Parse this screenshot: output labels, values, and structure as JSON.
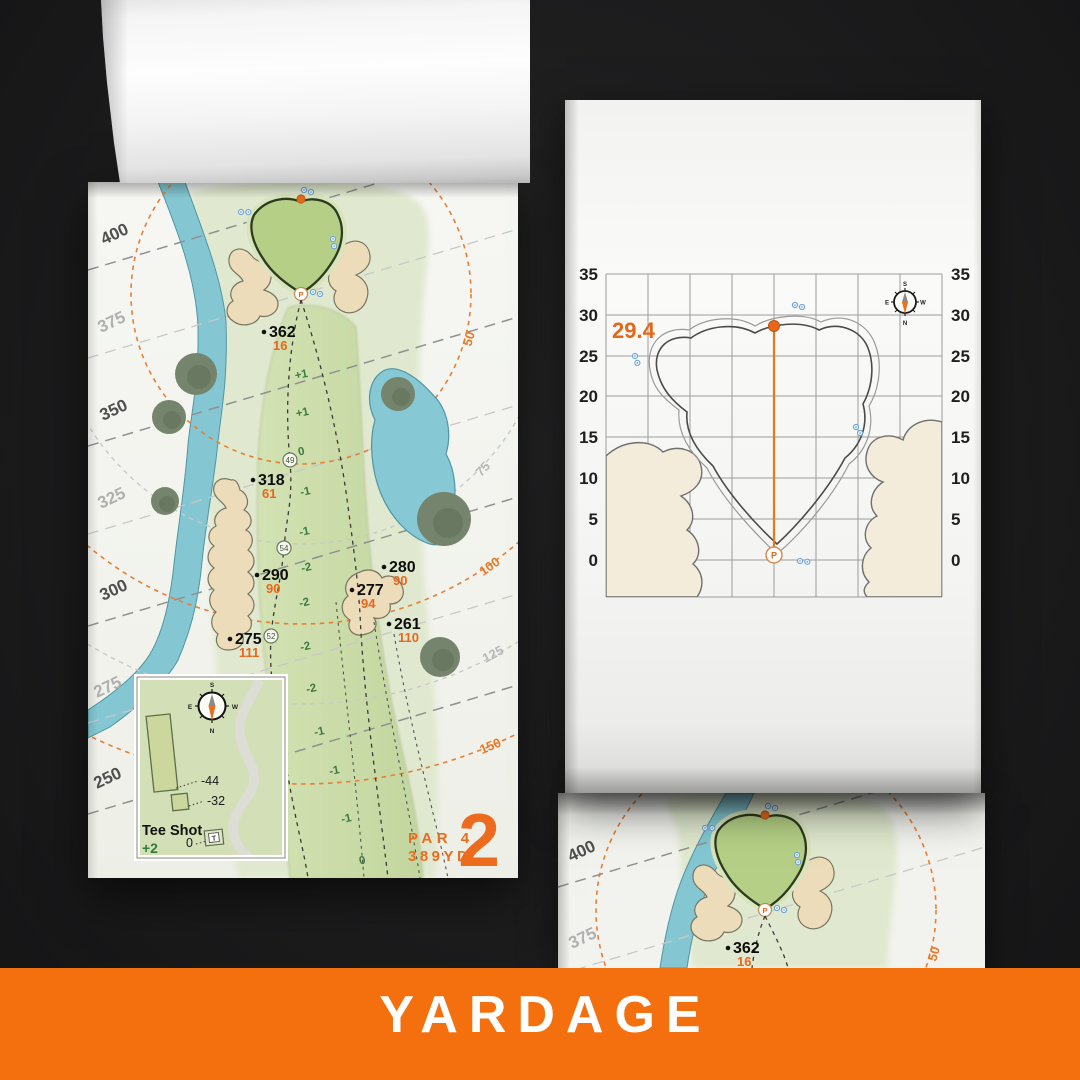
{
  "banner": {
    "label": "YARDAGE"
  },
  "colors": {
    "banner_orange": "#F4700F",
    "accent_orange": "#E8671C",
    "elevation_green": "#3A7A40",
    "water_teal": "#84C7D2",
    "sand": "#ECDDBC",
    "putting_green": "#B5D086"
  },
  "map_page": {
    "hole_number": "2",
    "par_label": "PAR 4",
    "yardage_label": "389YD",
    "distance_labels": [
      {
        "value": "400",
        "tone": "major"
      },
      {
        "value": "375",
        "tone": "minor"
      },
      {
        "value": "350",
        "tone": "major"
      },
      {
        "value": "325",
        "tone": "minor"
      },
      {
        "value": "300",
        "tone": "major"
      },
      {
        "value": "275",
        "tone": "minor"
      },
      {
        "value": "250",
        "tone": "major"
      }
    ],
    "arc_labels": [
      {
        "value": "50",
        "tone": "orange"
      },
      {
        "value": "75",
        "tone": "gray"
      },
      {
        "value": "100",
        "tone": "orange"
      },
      {
        "value": "125",
        "tone": "gray"
      },
      {
        "value": "150",
        "tone": "orange"
      }
    ],
    "markers": [
      {
        "distance": "362",
        "sub": "16"
      },
      {
        "distance": "318",
        "sub": "61"
      },
      {
        "distance": "290",
        "sub": "90"
      },
      {
        "distance": "280",
        "sub": "90"
      },
      {
        "distance": "277",
        "sub": "94"
      },
      {
        "distance": "261",
        "sub": "110"
      },
      {
        "distance": "275",
        "sub": "111"
      }
    ],
    "elevation_values": [
      "+1",
      "+1",
      "0",
      "-1",
      "-1",
      "-2",
      "-2",
      "-2",
      "-2",
      "-1",
      "-1",
      "-1",
      "0"
    ],
    "waypoint_values": [
      "49",
      "54",
      "52"
    ],
    "pin_label": "P",
    "tee_inset": {
      "title": "Tee Shot",
      "elevation": "+2",
      "carry_labels": [
        "-44",
        "-32",
        "0"
      ],
      "tee_label": "T",
      "compass": {
        "n": "N",
        "s": "S",
        "e": "E",
        "w": "W"
      }
    }
  },
  "green_page": {
    "depth_value": "29.4",
    "axis_ticks": [
      "35",
      "30",
      "25",
      "20",
      "15",
      "10",
      "5",
      "0"
    ],
    "pin_label": "P",
    "compass": {
      "n": "N",
      "s": "S",
      "e": "E",
      "w": "W"
    }
  },
  "bottom_page": {
    "distance_labels": [
      "400",
      "375"
    ],
    "arc_label": "50",
    "marker": {
      "distance": "362",
      "sub": "16"
    }
  }
}
